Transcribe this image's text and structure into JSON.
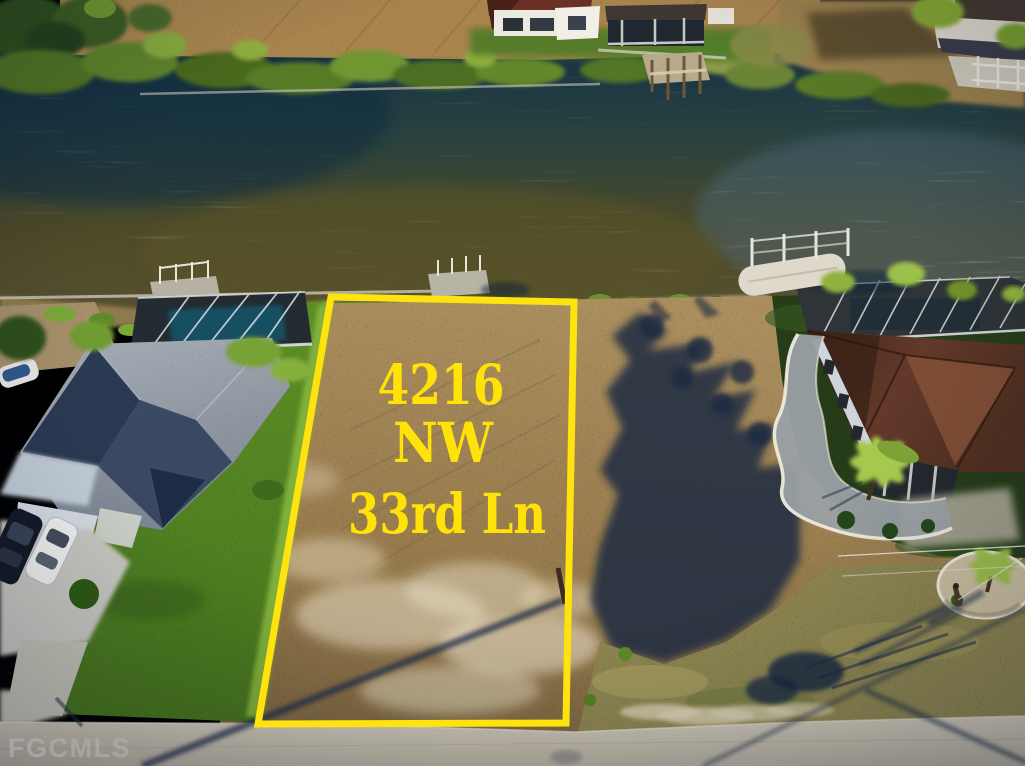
{
  "photo": {
    "type": "aerial-drone-real-estate-photo",
    "lot_label": {
      "line1": "4216",
      "line2": "NW",
      "line3": "33rd Ln"
    },
    "watermark": "FGCMLS"
  },
  "palette": {
    "lot_line_yellow": "#FFE30E",
    "lot_text_yellow": "#FFE207",
    "watermark_gray": "#ABABAB",
    "water_deep_blue": "#14334F",
    "water_olive": "#55502A",
    "dirt_tan": "#9A7D4F",
    "grass_green": "#5B8A28",
    "road_gray": "#C9C2B2",
    "shadow_navy": "#1D2B47",
    "roof_gray_lit": "#99A1AB",
    "roof_navy_shade": "#2C3A55",
    "roof_brown": "#5A3424",
    "pool_teal": "#175062",
    "sand_white": "#DDD2B4"
  }
}
